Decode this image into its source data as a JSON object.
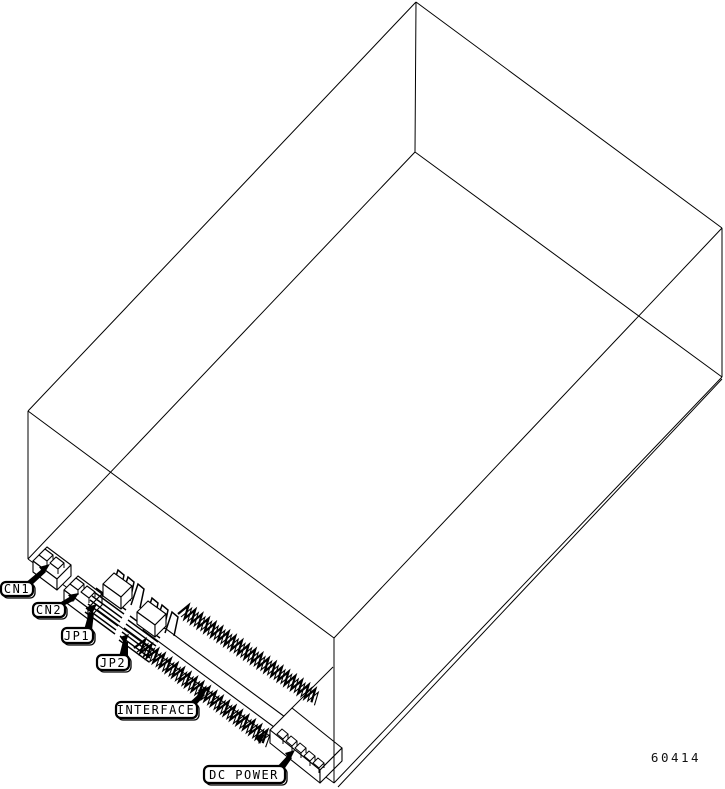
{
  "figure": {
    "type": "isometric-connector-location-diagram",
    "background": "#ffffff",
    "line_color": "#000000",
    "drawing_number": "60414",
    "callouts": [
      {
        "id": "cn1",
        "label": "CN1"
      },
      {
        "id": "cn2",
        "label": "CN2"
      },
      {
        "id": "jp1",
        "label": "JP1"
      },
      {
        "id": "jp2",
        "label": "JP2"
      },
      {
        "id": "interface",
        "label": "INTERFACE"
      },
      {
        "id": "dc-power",
        "label": "DC POWER"
      }
    ]
  }
}
